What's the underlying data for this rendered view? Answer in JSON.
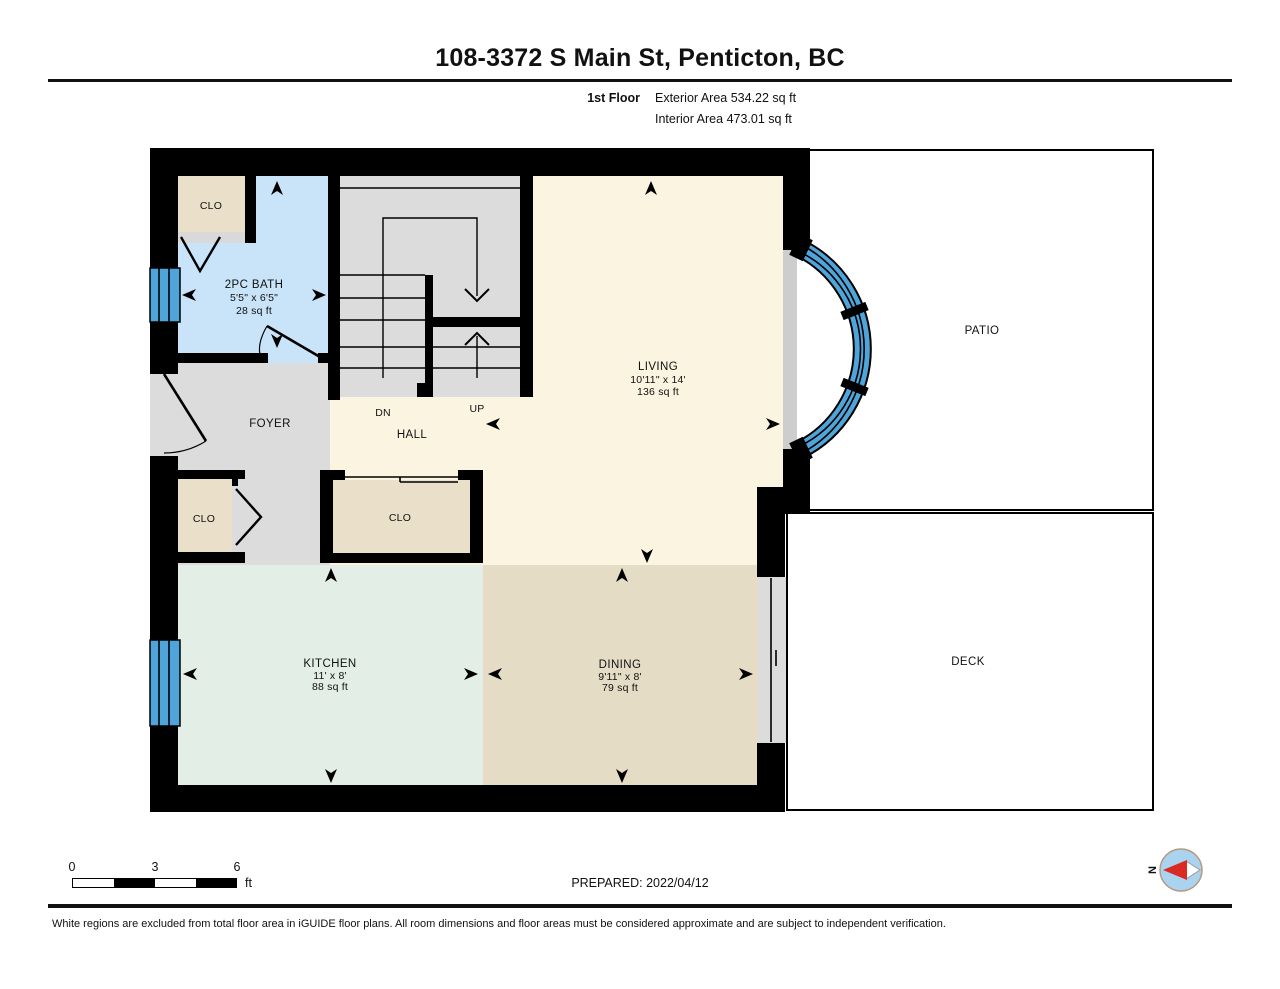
{
  "header": {
    "title": "108-3372 S Main St, Penticton, BC",
    "floor_label": "1st Floor",
    "exterior_area": "Exterior Area 534.22 sq ft",
    "interior_area": "Interior Area 473.01 sq ft"
  },
  "rooms": {
    "living": {
      "name": "LIVING",
      "dims": "10'11\" x 14'",
      "area": "136 sq ft"
    },
    "kitchen": {
      "name": "KITCHEN",
      "dims": "11' x 8'",
      "area": "88 sq ft"
    },
    "dining": {
      "name": "DINING",
      "dims": "9'11\" x 8'",
      "area": "79 sq ft"
    },
    "bath": {
      "name": "2PC BATH",
      "dims": "5'5\" x 6'5\"",
      "area": "28 sq ft"
    },
    "foyer": {
      "name": "FOYER"
    },
    "hall": {
      "name": "HALL"
    },
    "patio": {
      "name": "PATIO"
    },
    "deck": {
      "name": "DECK"
    },
    "closet_top": {
      "name": "CLO"
    },
    "closet_left": {
      "name": "CLO"
    },
    "closet_center": {
      "name": "CLO"
    },
    "stairs": {
      "down_label": "DN",
      "up_label": "UP"
    }
  },
  "scale_bar": {
    "tick0": "0",
    "tick3": "3",
    "tick6": "6",
    "unit": "ft"
  },
  "prepared_label": "PREPARED: 2022/04/12",
  "compass": {
    "north_label": "N"
  },
  "footer": {
    "disclaimer": "White regions are excluded from total floor area in iGUIDE floor plans. All room dimensions and floor areas must be considered approximate and are subject to independent verification."
  },
  "colors": {
    "wall": "#000000",
    "window_blue": "#4FA5D9",
    "living_cream": "#FBF4E0",
    "bath_blue": "#C9E4F8",
    "kitchen_green": "#E3EEE6",
    "dining_tan": "#E5DCC6",
    "closet_beige": "#EADFC8",
    "floor_gray": "#DCDCDC",
    "sill_gray": "#CDCDCD",
    "compass_blue": "#A9D3EE",
    "compass_red": "#D92B21"
  }
}
